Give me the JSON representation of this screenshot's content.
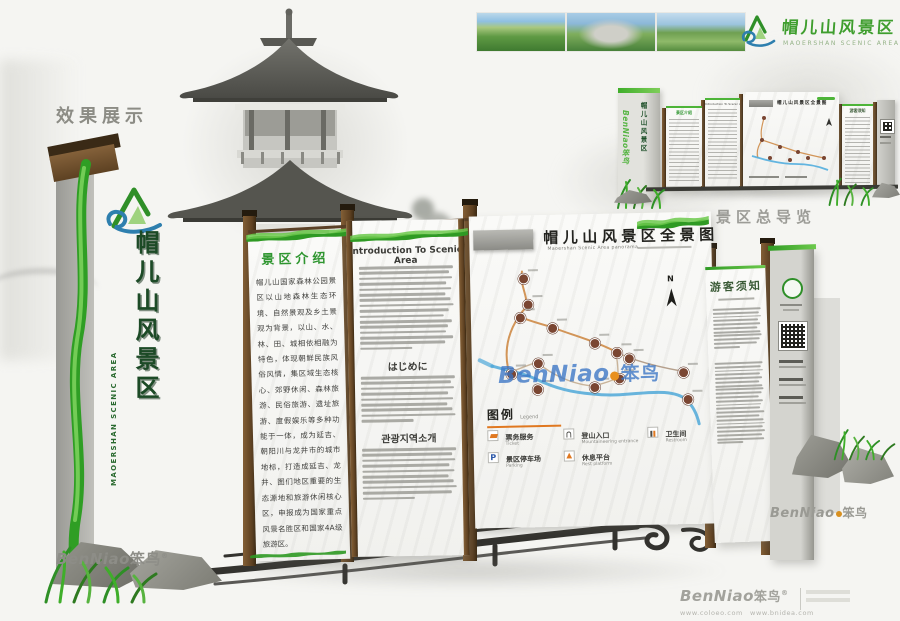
{
  "header": {
    "brand_cn": "帽儿山风景区",
    "brand_en": "MAOERSHAN SCENIC AREA",
    "photo_names": [
      "mountain-valley-photo",
      "stone-gate-photo",
      "meadow-peak-photo"
    ]
  },
  "section_labels": {
    "effect_display": "效果展示",
    "overview_caption": "景区总导览"
  },
  "monument": {
    "vertical_title_cn": "帽儿山风景区",
    "vertical_title_en": "MAOERSHAN SCENIC AREA"
  },
  "panel_intro": {
    "title": "景区介绍",
    "body": "帽儿山国家森林公园景区以山地森林生态环境、自然景观及乡土景观为背景，以山、水、林、田、城相依相融为特色，体现朝鲜民族风俗风情，集区域生态核心、郊野休闲、森林旅游、民俗旅游、遗址旅游、度假娱乐等多种功能于一体，成为延吉、朝阳川与龙井市的城市地标，打造成延吉、龙井、图们地区重要的生态源地和旅游休闲核心区，申报成为国家重点风景名胜区和国家4A级旅游区。"
  },
  "panel_multilang": {
    "title_en": "Introduction To Scenic Area",
    "en_lines": 16,
    "title_jp": "はじめに",
    "jp_lines": 9,
    "title_kr": "관광지역소개",
    "kr_lines": 10
  },
  "panel_map": {
    "title": "帽儿山风景区全景图",
    "subtitle": "Maoershan Scenic Area panorama",
    "compass_label": "N",
    "legend": {
      "title": "图例",
      "title_sub": "Legend",
      "items": [
        {
          "cn": "票务服务",
          "sub": "Ticket",
          "icon": "ticket-icon"
        },
        {
          "cn": "登山入口",
          "sub": "Mountaineering entrance",
          "icon": "entrance-icon"
        },
        {
          "cn": "卫生间",
          "sub": "Restroom",
          "icon": "restroom-icon"
        },
        {
          "cn": "景区停车场",
          "sub": "Parking",
          "icon": "parking-icon",
          "icon_label": "P"
        },
        {
          "cn": "休息平台",
          "sub": "Rest platform",
          "icon": "platform-icon"
        }
      ]
    },
    "markers": [
      [
        52,
        62
      ],
      [
        56,
        88
      ],
      [
        48,
        101
      ],
      [
        80,
        112
      ],
      [
        122,
        128
      ],
      [
        144,
        138
      ],
      [
        156,
        144
      ],
      [
        65,
        147
      ],
      [
        38,
        157
      ],
      [
        64,
        173
      ],
      [
        121,
        172
      ],
      [
        146,
        164
      ],
      [
        210,
        159
      ],
      [
        214,
        186
      ]
    ]
  },
  "panel_notice": {
    "title": "游客须知",
    "list_lines": 11,
    "para_lines": 22
  },
  "watermark": {
    "brand": "BenNiao",
    "brand_cn": "笨鸟",
    "reg": "®"
  },
  "footer": {
    "urls": "www.coloeo.com　www.bnidea.com"
  }
}
